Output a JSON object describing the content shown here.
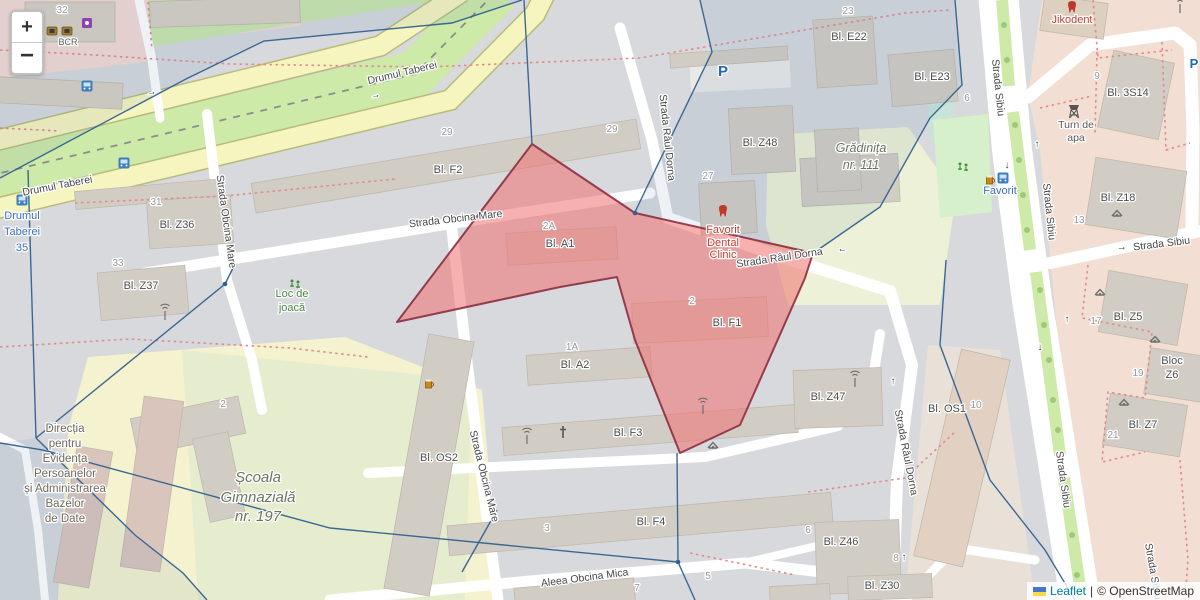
{
  "attribution": {
    "leaflet_label": "Leaflet",
    "separator": "|",
    "osm_label": "© OpenStreetMap"
  },
  "zoom_control": {
    "zoom_in_label": "+",
    "zoom_out_label": "−"
  },
  "labels": {
    "streets": [
      {
        "t": "Drumul Taberei",
        "x": 403,
        "y": 76,
        "r": -13.5
      },
      {
        "t": "Drumul Taberei",
        "x": 58,
        "y": 189,
        "r": -11
      },
      {
        "t": "Strada Obcina Mare",
        "x": 456,
        "y": 222,
        "r": -6.5
      },
      {
        "t": "Strada Obcina Mare",
        "x": 481,
        "y": 477,
        "r": 76
      },
      {
        "t": "Strada Obcina Mare",
        "x": 223,
        "y": 222,
        "r": 82
      },
      {
        "t": "Strada Râul Dorna",
        "x": 664,
        "y": 138,
        "r": 84
      },
      {
        "t": "Strada Râul Dorna",
        "x": 780,
        "y": 261,
        "r": -8.5
      },
      {
        "t": "Strada Râul Dorna",
        "x": 903,
        "y": 453,
        "r": 79
      },
      {
        "t": "Strada Sibiu",
        "x": 995,
        "y": 88,
        "r": 84
      },
      {
        "t": "Strada Sibiu",
        "x": 1046,
        "y": 212,
        "r": 84
      },
      {
        "t": "Strada Sibiu",
        "x": 1162,
        "y": 247,
        "r": -7
      },
      {
        "t": "Strada Sibiu",
        "x": 1060,
        "y": 480,
        "r": 82
      },
      {
        "t": "Strada Sibiu",
        "x": 1150,
        "y": 572,
        "r": 80
      },
      {
        "t": "Aleea Obcina Mica",
        "x": 585,
        "y": 581,
        "r": -7.5
      }
    ],
    "buildings": [
      {
        "t": "Bl. F2",
        "x": 448,
        "y": 173
      },
      {
        "t": "Bl. A1",
        "x": 560,
        "y": 247
      },
      {
        "t": "Bl. A2",
        "x": 575,
        "y": 368
      },
      {
        "t": "Bl. F3",
        "x": 628,
        "y": 436
      },
      {
        "t": "Bl. F4",
        "x": 651,
        "y": 525
      },
      {
        "t": "Bl. F1",
        "x": 727,
        "y": 326
      },
      {
        "t": "Bl. OS2",
        "x": 439,
        "y": 461
      },
      {
        "t": "Bl. OS1",
        "x": 947,
        "y": 412
      },
      {
        "t": "Bl. Z36",
        "x": 177,
        "y": 228
      },
      {
        "t": "Bl. Z37",
        "x": 141,
        "y": 289
      },
      {
        "t": "Bl. Z48",
        "x": 760,
        "y": 146
      },
      {
        "t": "Bl. Z47",
        "x": 828,
        "y": 400
      },
      {
        "t": "Bl. Z46",
        "x": 841,
        "y": 545
      },
      {
        "t": "Bl. Z30",
        "x": 882,
        "y": 589
      },
      {
        "t": "Bl. E22",
        "x": 849,
        "y": 40
      },
      {
        "t": "Bl. E23",
        "x": 932,
        "y": 80
      },
      {
        "t": "Bl. 3S14",
        "x": 1128,
        "y": 96
      },
      {
        "t": "Bl. Z18",
        "x": 1118,
        "y": 201
      },
      {
        "t": "Bl. Z5",
        "x": 1128,
        "y": 320
      },
      {
        "t": "Bloc",
        "x": 1172,
        "y": 364
      },
      {
        "t": "Z6",
        "x": 1172,
        "y": 378
      },
      {
        "t": "Bl. Z7",
        "x": 1143,
        "y": 428
      }
    ],
    "numbers": [
      {
        "t": "29",
        "x": 447,
        "y": 135
      },
      {
        "t": "29",
        "x": 612,
        "y": 132
      },
      {
        "t": "2A",
        "x": 549,
        "y": 229
      },
      {
        "t": "1A",
        "x": 572,
        "y": 350
      },
      {
        "t": "2",
        "x": 692,
        "y": 304
      },
      {
        "t": "3",
        "x": 547,
        "y": 531
      },
      {
        "t": "23",
        "x": 848,
        "y": 14
      },
      {
        "t": "27",
        "x": 708,
        "y": 179
      },
      {
        "t": "31",
        "x": 156,
        "y": 205
      },
      {
        "t": "33",
        "x": 118,
        "y": 266
      },
      {
        "t": "6",
        "x": 967,
        "y": 101
      },
      {
        "t": "9",
        "x": 1097,
        "y": 79
      },
      {
        "t": "13",
        "x": 1079,
        "y": 223
      },
      {
        "t": "17",
        "x": 1096,
        "y": 324
      },
      {
        "t": "19",
        "x": 1138,
        "y": 376
      },
      {
        "t": "21",
        "x": 1113,
        "y": 438
      },
      {
        "t": "10",
        "x": 976,
        "y": 408
      },
      {
        "t": "6",
        "x": 808,
        "y": 533
      },
      {
        "t": "8",
        "x": 896,
        "y": 561
      },
      {
        "t": "7",
        "x": 637,
        "y": 591
      },
      {
        "t": "5",
        "x": 708,
        "y": 579
      },
      {
        "t": "2",
        "x": 223,
        "y": 407
      },
      {
        "t": "32",
        "x": 62,
        "y": 13
      }
    ],
    "pois": [
      {
        "t": "Favorit",
        "x": 723,
        "y": 233,
        "c": "poi-red"
      },
      {
        "t": "Dental",
        "x": 723,
        "y": 246,
        "c": "poi-red"
      },
      {
        "t": "Clinic",
        "x": 723,
        "y": 258,
        "c": "poi-red"
      },
      {
        "t": "Jikodent",
        "x": 1072,
        "y": 23,
        "c": "poi-red"
      },
      {
        "t": "Favorit",
        "x": 1000,
        "y": 194,
        "c": "poi-blue"
      },
      {
        "t": "Drumul",
        "x": 22,
        "y": 219,
        "c": "poi-blue"
      },
      {
        "t": "Taberei",
        "x": 22,
        "y": 235,
        "c": "poi-blue"
      },
      {
        "t": "35",
        "x": 22,
        "y": 251,
        "c": "poi-blue"
      },
      {
        "t": "Loc de",
        "x": 292,
        "y": 297,
        "c": "poi-green"
      },
      {
        "t": "joacă",
        "x": 292,
        "y": 311,
        "c": "poi-green"
      },
      {
        "t": "Turn de",
        "x": 1076,
        "y": 128,
        "c": "poi-gray"
      },
      {
        "t": "apa",
        "x": 1076,
        "y": 141,
        "c": "poi-gray"
      },
      {
        "t": "BCR",
        "x": 68,
        "y": 45,
        "c": "poi-gray-sm"
      },
      {
        "t": "Școala",
        "x": 258,
        "y": 482,
        "c": "school"
      },
      {
        "t": "Gimnazială",
        "x": 258,
        "y": 502,
        "c": "school"
      },
      {
        "t": "nr. 197",
        "x": 258,
        "y": 521,
        "c": "school"
      },
      {
        "t": "Grădinița",
        "x": 861,
        "y": 152,
        "c": "school-sm"
      },
      {
        "t": "nr. 111",
        "x": 861,
        "y": 169,
        "c": "school-sm"
      },
      {
        "t": "Direcția",
        "x": 65,
        "y": 432,
        "c": "muni"
      },
      {
        "t": "pentru",
        "x": 65,
        "y": 447,
        "c": "muni"
      },
      {
        "t": "Evidența",
        "x": 65,
        "y": 462,
        "c": "muni"
      },
      {
        "t": "Persoanelor",
        "x": 65,
        "y": 477,
        "c": "muni"
      },
      {
        "t": "și Administrarea",
        "x": 65,
        "y": 492,
        "c": "muni"
      },
      {
        "t": "Bazelor",
        "x": 65,
        "y": 507,
        "c": "muni"
      },
      {
        "t": "de Date",
        "x": 65,
        "y": 522,
        "c": "muni"
      }
    ],
    "arrows": [
      {
        "g": "→",
        "x": 376,
        "y": 98,
        "r": -13
      },
      {
        "g": "→",
        "x": 152,
        "y": 95,
        "r": -13
      },
      {
        "g": "←",
        "x": 842,
        "y": 252,
        "r": 10
      },
      {
        "g": "↑",
        "x": 1037,
        "y": 147,
        "r": 0
      },
      {
        "g": "↓",
        "x": 1007,
        "y": 168,
        "r": 0
      },
      {
        "g": "↑",
        "x": 1067,
        "y": 322,
        "r": 0
      },
      {
        "g": "↓",
        "x": 1040,
        "y": 350,
        "r": 0
      },
      {
        "g": "→",
        "x": 1122,
        "y": 250,
        "r": -6
      },
      {
        "g": "↑",
        "x": 893,
        "y": 384,
        "r": 0
      },
      {
        "g": "↑",
        "x": 904,
        "y": 560,
        "r": 0
      }
    ],
    "parking": [
      {
        "t": "P",
        "x": 723,
        "y": 76,
        "s": 15
      },
      {
        "t": "P",
        "x": 1194,
        "y": 68,
        "s": 13
      }
    ]
  },
  "icons": [
    {
      "t": "tooth",
      "x": 723,
      "y": 212
    },
    {
      "t": "tooth",
      "x": 1072,
      "y": 8
    },
    {
      "t": "mast",
      "x": 165,
      "y": 313
    },
    {
      "t": "mast",
      "x": 527,
      "y": 437
    },
    {
      "t": "mast",
      "x": 703,
      "y": 407
    },
    {
      "t": "mast",
      "x": 855,
      "y": 380
    },
    {
      "t": "mast",
      "x": 1180,
      "y": 6
    },
    {
      "t": "cross",
      "x": 563,
      "y": 433
    },
    {
      "t": "shelter",
      "x": 713,
      "y": 446
    },
    {
      "t": "shelter",
      "x": 1117,
      "y": 214
    },
    {
      "t": "shelter",
      "x": 1100,
      "y": 293
    },
    {
      "t": "shelter",
      "x": 1155,
      "y": 340
    },
    {
      "t": "shelter",
      "x": 1124,
      "y": 403
    },
    {
      "t": "playground",
      "x": 295,
      "y": 283
    },
    {
      "t": "playground",
      "x": 963,
      "y": 166
    },
    {
      "t": "bus",
      "x": 22,
      "y": 200
    },
    {
      "t": "bus",
      "x": 124,
      "y": 163
    },
    {
      "t": "bus",
      "x": 87,
      "y": 86
    },
    {
      "t": "bus",
      "x": 1003,
      "y": 178
    },
    {
      "t": "beer",
      "x": 429,
      "y": 384
    },
    {
      "t": "beer",
      "x": 990,
      "y": 180
    },
    {
      "t": "watertower",
      "x": 1074,
      "y": 112
    },
    {
      "t": "atm",
      "x": 52,
      "y": 31
    },
    {
      "t": "atm",
      "x": 67,
      "y": 31
    },
    {
      "t": "shop",
      "x": 87,
      "y": 23
    }
  ],
  "overlays": {
    "pink_fill": "#f07070",
    "pink_opacity": 0.55,
    "pink_stroke": "#8c2d40",
    "pink_polygon": [
      [
        532,
        144
      ],
      [
        635,
        213
      ],
      [
        813,
        253
      ],
      [
        805,
        278
      ],
      [
        740,
        425
      ],
      [
        680,
        453
      ],
      [
        635,
        340
      ],
      [
        617,
        277
      ],
      [
        560,
        287
      ],
      [
        397,
        322
      ]
    ],
    "blue_stroke": "#31618f",
    "blue_lines": [
      [
        [
          0,
          178
        ],
        [
          186,
          79
        ],
        [
          264,
          41
        ],
        [
          452,
          23
        ],
        [
          522,
          0
        ]
      ],
      [
        [
          524,
          0
        ],
        [
          532,
          144
        ]
      ],
      [
        [
          635,
          212
        ],
        [
          712,
          52
        ],
        [
          700,
          0
        ]
      ],
      [
        [
          28,
          170
        ],
        [
          36,
          438
        ]
      ],
      [
        [
          36,
          438
        ],
        [
          135,
          535
        ],
        [
          183,
          573
        ],
        [
          207,
          600
        ]
      ],
      [
        [
          36,
          438
        ],
        [
          225,
          284
        ],
        [
          233,
          268
        ]
      ],
      [
        [
          0,
          443
        ],
        [
          43,
          450
        ],
        [
          330,
          528
        ],
        [
          678,
          562
        ]
      ],
      [
        [
          678,
          562
        ],
        [
          695,
          600
        ]
      ],
      [
        [
          678,
          562
        ],
        [
          677,
          453
        ]
      ],
      [
        [
          955,
          0
        ],
        [
          962,
          85
        ],
        [
          930,
          118
        ],
        [
          880,
          207
        ],
        [
          812,
          254
        ]
      ],
      [
        [
          946,
          260
        ],
        [
          940,
          345
        ],
        [
          990,
          480
        ],
        [
          1045,
          550
        ],
        [
          1075,
          600
        ]
      ],
      [
        [
          497,
          510
        ],
        [
          462,
          572
        ]
      ]
    ],
    "blue_dots": [
      [
        635,
        213
      ],
      [
        225,
        284
      ],
      [
        678,
        562
      ]
    ],
    "cell_fill": "rgba(70,110,160,0.09)",
    "cells": [
      [
        [
          0,
          0
        ],
        [
          522,
          0
        ],
        [
          452,
          23
        ],
        [
          264,
          41
        ],
        [
          186,
          79
        ],
        [
          0,
          178
        ]
      ],
      [
        [
          700,
          0
        ],
        [
          955,
          0
        ],
        [
          962,
          85
        ],
        [
          930,
          118
        ],
        [
          880,
          207
        ],
        [
          812,
          254
        ],
        [
          635,
          213
        ],
        [
          712,
          52
        ]
      ],
      [
        [
          0,
          443
        ],
        [
          36,
          438
        ],
        [
          135,
          535
        ],
        [
          183,
          573
        ],
        [
          207,
          600
        ],
        [
          0,
          600
        ]
      ]
    ]
  }
}
